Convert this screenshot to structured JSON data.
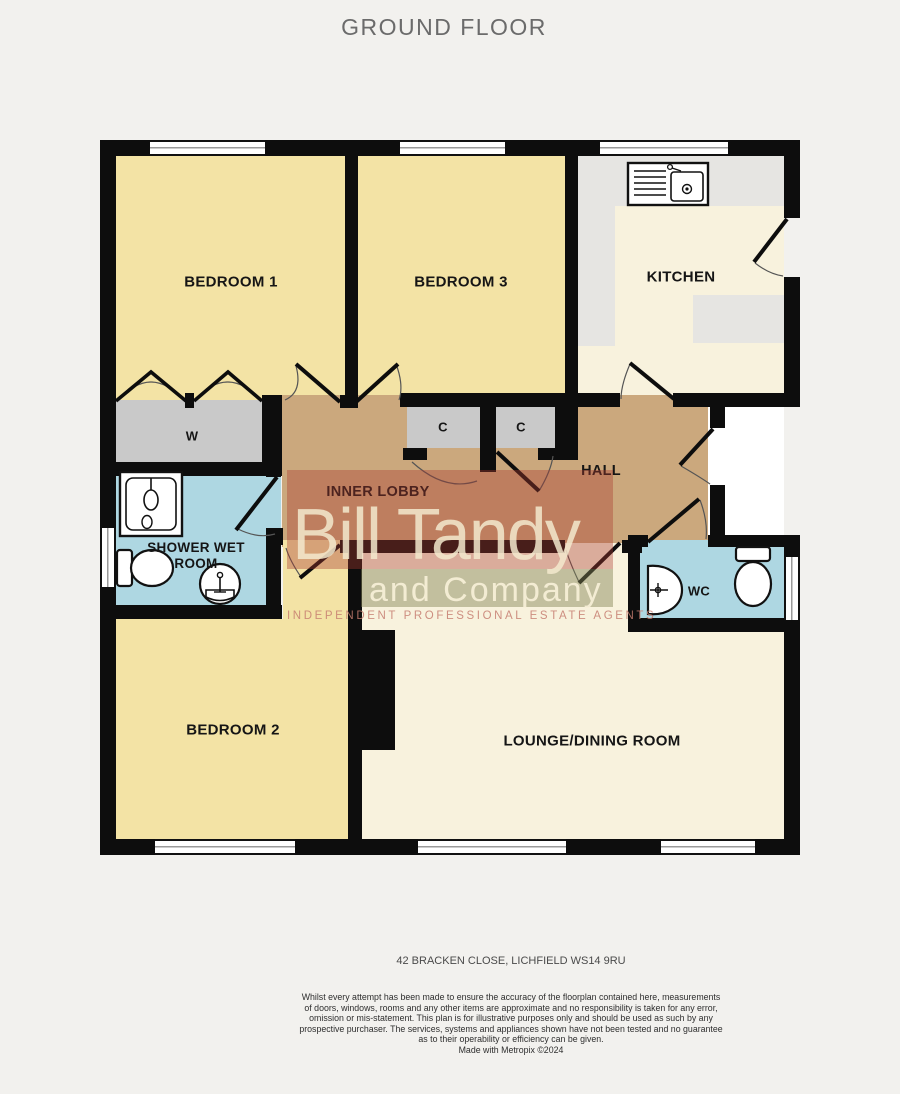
{
  "title": "GROUND FLOOR",
  "address": "42 BRACKEN CLOSE, LICHFIELD WS14 9RU",
  "rooms": {
    "bedroom1": {
      "label": "BEDROOM 1"
    },
    "bedroom3": {
      "label": "BEDROOM 3"
    },
    "kitchen": {
      "label": "KITCHEN"
    },
    "wardrobe": {
      "label": "W"
    },
    "cupboard1": {
      "label": "C"
    },
    "cupboard2": {
      "label": "C"
    },
    "hall": {
      "label": "HALL"
    },
    "inner_lobby": {
      "label": "INNER LOBBY"
    },
    "shower_wet_room": {
      "label": "SHOWER WET ROOM"
    },
    "wc": {
      "label": "WC"
    },
    "bedroom2": {
      "label": "BEDROOM 2"
    },
    "lounge_dining": {
      "label": "LOUNGE/DINING ROOM"
    }
  },
  "watermark": {
    "line1": "Bill Tandy",
    "line2": "and Company",
    "line3": "INDEPENDENT PROFESSIONAL ESTATE AGENTS"
  },
  "footer": {
    "disclaimer_lines": [
      "Whilst every attempt has been made to ensure the accuracy of the floorplan contained here, measurements",
      "of doors, windows, rooms and any other items are approximate and no responsibility is taken for any error,",
      "omission or mis-statement. This plan is for illustrative purposes only and should be used as such by any",
      "prospective purchaser. The services, systems and appliances shown have not been tested and no guarantee",
      "as to their operability or efficiency can be given.",
      "Made with Metropix ©2024"
    ]
  },
  "colors": {
    "bedroom_yellow": "#f3e3a5",
    "cream": "#f8f2dd",
    "hall_tan": "#cba87d",
    "closet_gray": "#c9c9c9",
    "counter_gray": "#e6e5e2",
    "wet_room_blue": "#aed7e2",
    "wall_black": "#0d0d0d",
    "watermark_red": "rgba(168,58,48,0.38)",
    "watermark_green": "rgba(128,128,82,0.45)"
  }
}
